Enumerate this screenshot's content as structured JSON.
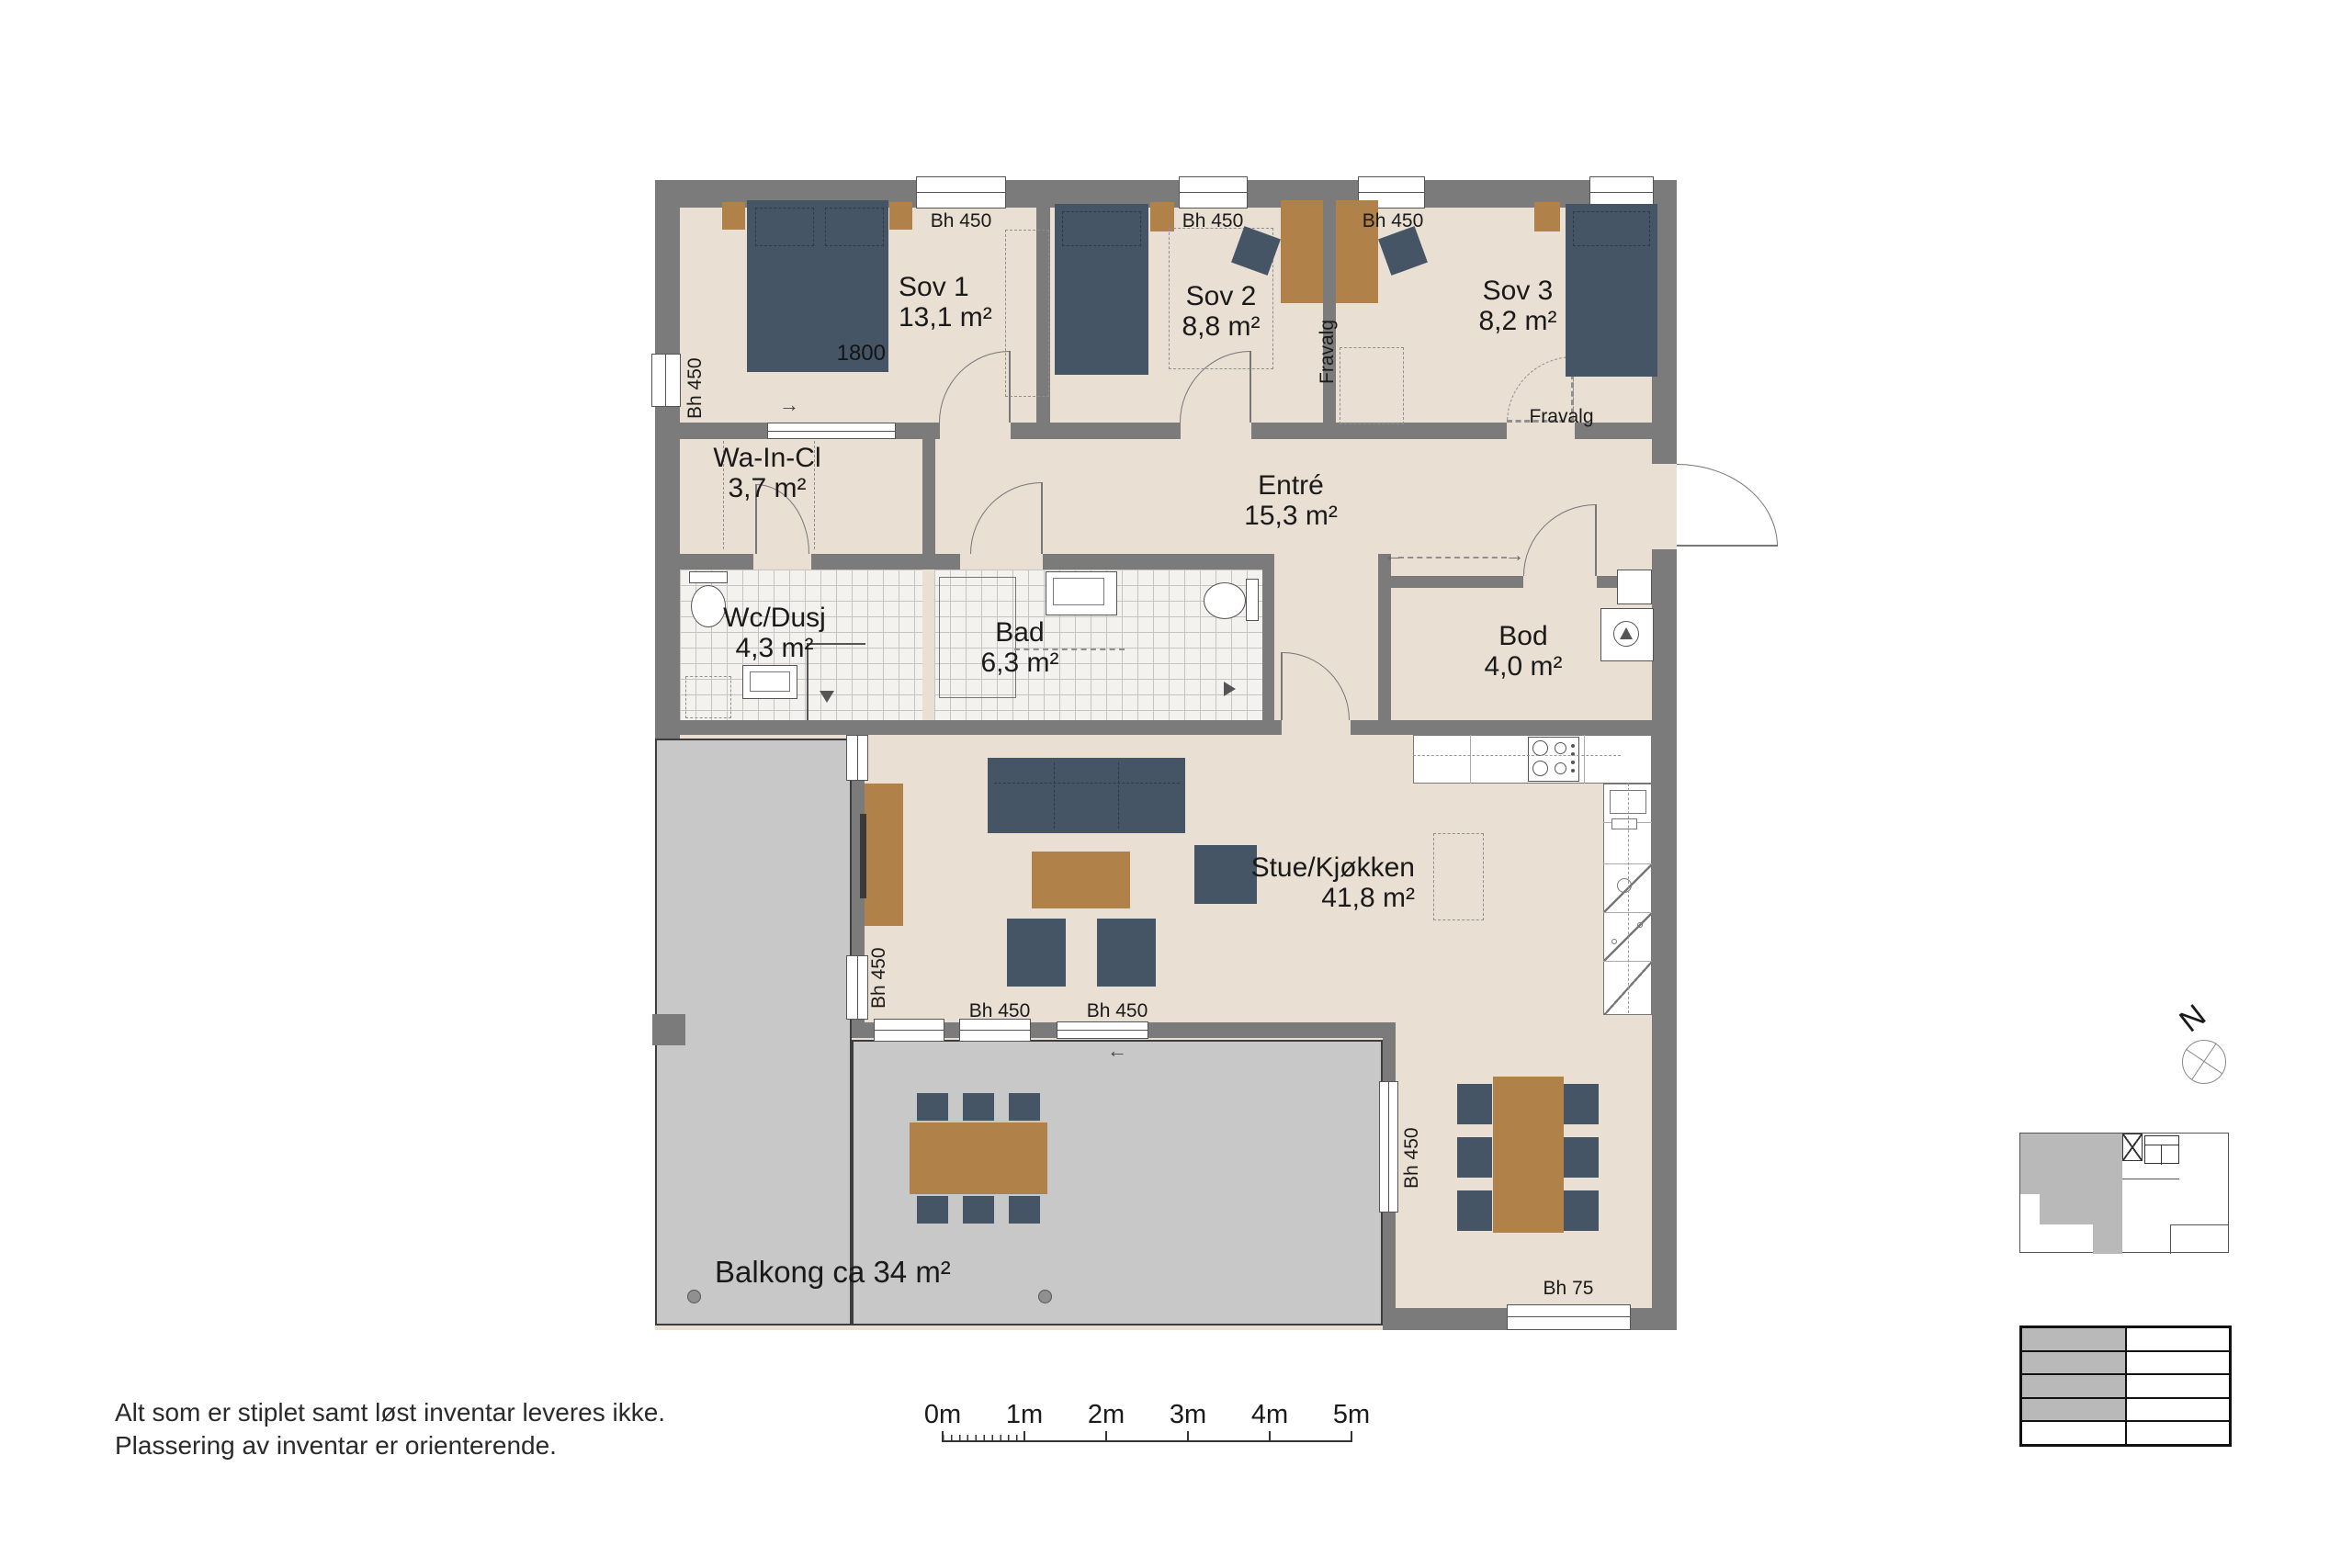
{
  "colors": {
    "wall": "#7b7b7b",
    "floor": "#e9dfd3",
    "tile": "#f3f2ef",
    "balcony": "#c8c8c8",
    "furniture_blue": "#455565",
    "furniture_wood": "#b0824a"
  },
  "rooms": {
    "sov1": {
      "name": "Sov 1",
      "area": "13,1 m²"
    },
    "sov2": {
      "name": "Sov 2",
      "area": "8,8 m²"
    },
    "sov3": {
      "name": "Sov 3",
      "area": "8,2 m²"
    },
    "wain": {
      "name": "Wa-In-Cl",
      "area": "3,7 m²"
    },
    "entre": {
      "name": "Entré",
      "area": "15,3 m²"
    },
    "wc": {
      "name": "Wc/Dusj",
      "area": "4,3 m²"
    },
    "bad": {
      "name": "Bad",
      "area": "6,3 m²"
    },
    "bod": {
      "name": "Bod",
      "area": "4,0 m²"
    },
    "stue": {
      "name": "Stue/Kjøkken",
      "area": "41,8 m²"
    },
    "balkong": {
      "name": "Balkong ca 34 m²"
    }
  },
  "annotations": {
    "bh450": "Bh 450",
    "bh75": "Bh 75",
    "bed_width": "1800",
    "fravalg": "Fravalg",
    "north": "N",
    "arrow_left": "←",
    "arrow_right": "→"
  },
  "notes": {
    "line1": "Alt som er stiplet samt løst inventar leveres ikke.",
    "line2": "Plassering av inventar er orienterende."
  },
  "scalebar": {
    "labels": [
      "0m",
      "1m",
      "2m",
      "3m",
      "4m",
      "5m"
    ]
  }
}
